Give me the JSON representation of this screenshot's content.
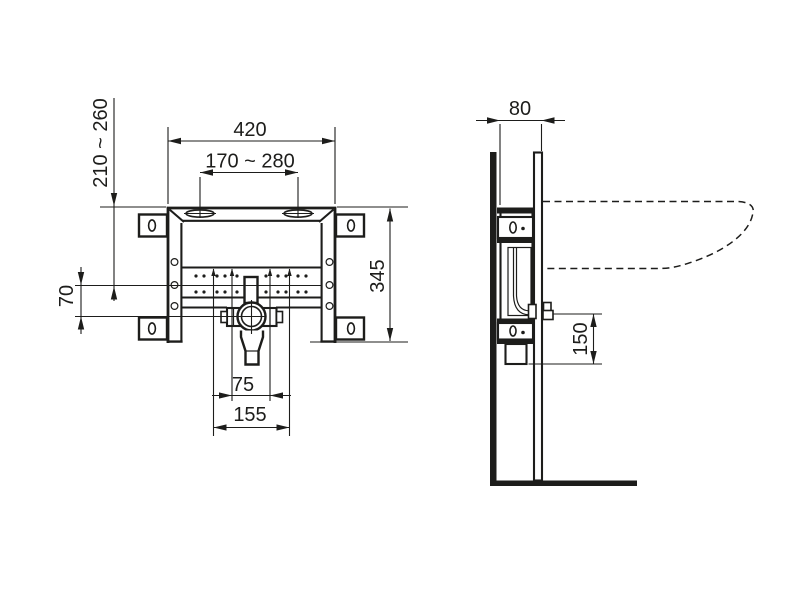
{
  "drawing": {
    "dimensions": {
      "front": {
        "frame_width": "420",
        "fixing_slot_spacing": "170 ~ 280",
        "height_adjust_range": "210 ~ 260",
        "tap_rail_to_drain": "70",
        "frame_height": "345",
        "drain_clamp_width": "75",
        "drain_support_width": "155"
      },
      "side": {
        "frame_depth": "80",
        "drain_outlet_drop": "150"
      }
    }
  }
}
